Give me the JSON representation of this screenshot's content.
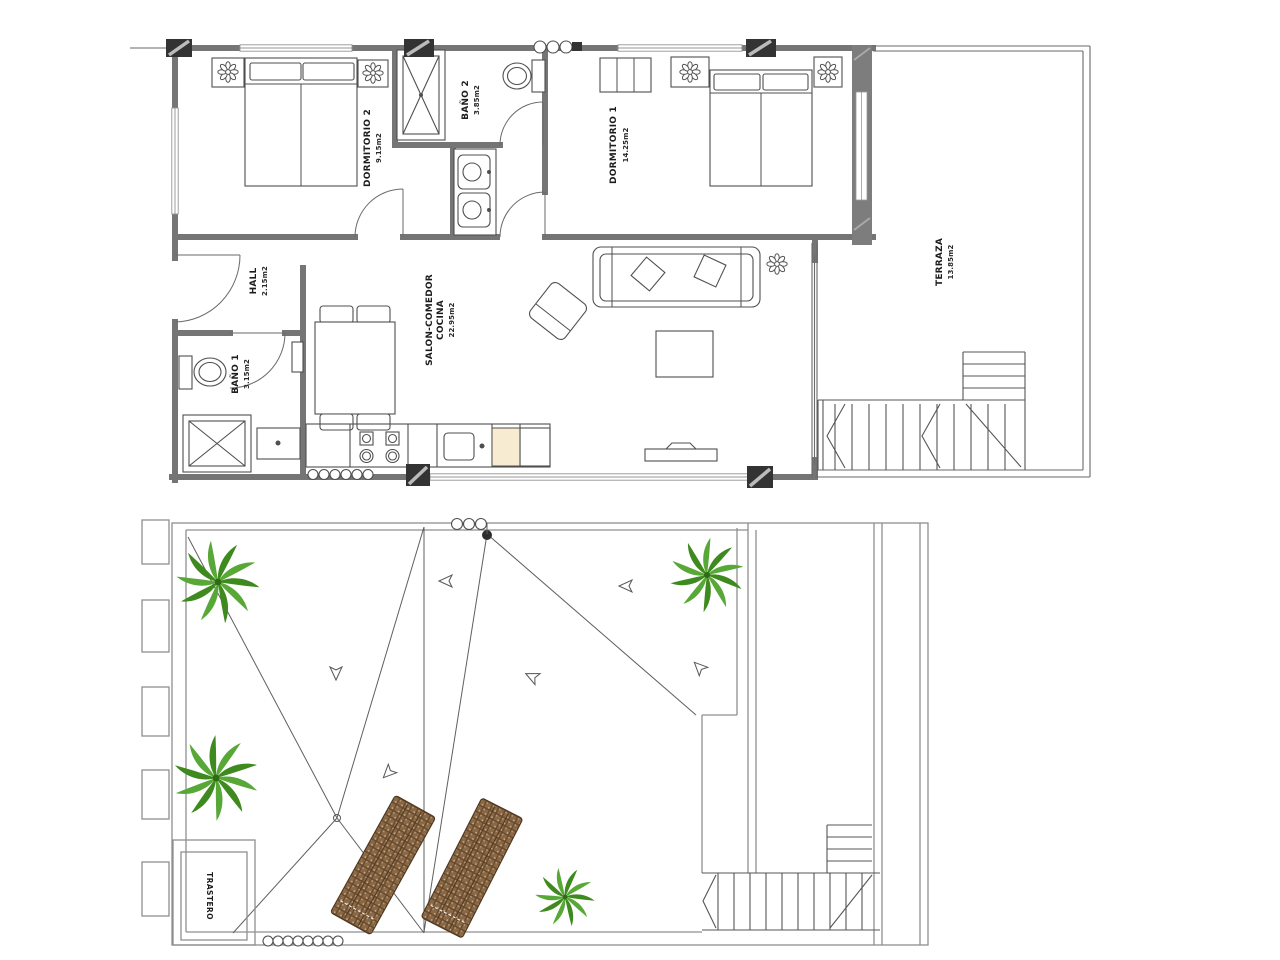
{
  "plan": {
    "upper_floor": {
      "rooms": [
        {
          "name": "DORMITORIO 2",
          "area": "9.15m2"
        },
        {
          "name": "BAÑO 2",
          "area": "3.85m2"
        },
        {
          "name": "DORMITORIO 1",
          "area": "14.25m2"
        },
        {
          "name": "HALL",
          "area": "2.15m2"
        },
        {
          "name": "BAÑO 1",
          "area": "3.15m2"
        },
        {
          "name": "SALON-COMEDOR",
          "name_line2": "COCINA",
          "area": "22.95m2"
        },
        {
          "name": "TERRAZA",
          "area": "13.85m2"
        }
      ]
    },
    "roof_floor": {
      "rooms": [
        {
          "name": "TRASTERO"
        }
      ]
    },
    "colors": {
      "wall_gray": "#757575",
      "line_gray": "#5f5f5f",
      "column_black": "#333333",
      "palm_green_dark": "#3e8a1f",
      "palm_green_light": "#58a838",
      "lounger_brown": "#8a6745",
      "cabinet_tan": "#f7ecd2"
    }
  }
}
